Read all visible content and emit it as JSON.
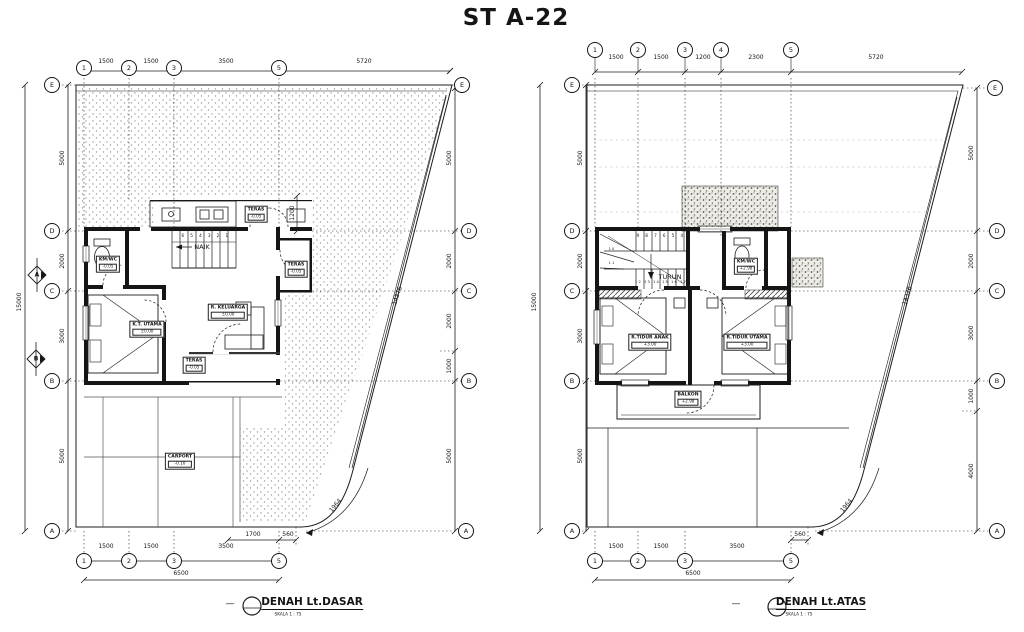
{
  "title": "ST A-22",
  "shared": {
    "diagonal_dim": "14376",
    "corner_arc_dim": "1964",
    "total_height": "15000",
    "total_width": "6500",
    "dash": "—"
  },
  "left_plan": {
    "caption": "DENAH Lt.DASAR",
    "scale": "SKALA 1 : 75",
    "cols": [
      "1",
      "2",
      "3",
      "5"
    ],
    "rows": [
      "E",
      "D",
      "C",
      "B",
      "A"
    ],
    "top_dims": [
      "1500",
      "1500",
      "3500",
      "5720"
    ],
    "bottom_dims": [
      "1500",
      "1500",
      "3500"
    ],
    "sub_dims": {
      "d1700": "1700",
      "d560": "560"
    },
    "left_dims": [
      "5000",
      "2000",
      "3000",
      "5000"
    ],
    "right_dims": [
      "5000",
      "2000",
      "2000",
      "1000",
      "5000"
    ],
    "terrace_depth_dim": "1200",
    "stair_label": "NAIK",
    "stair_numbers": "6 5 4 3 2 1",
    "section_markers": [
      "A",
      "B"
    ],
    "rooms": {
      "kmwc": {
        "name": "KM/WC",
        "elev": "-0.05"
      },
      "teras_top": {
        "name": "TERAS",
        "elev": "-0.05"
      },
      "teras_side": {
        "name": "TERAS",
        "elev": "-0.05"
      },
      "bedroom": {
        "name": "K.T. UTAMA",
        "elev": "±0.00"
      },
      "family": {
        "name": "R. KELUARGA",
        "elev": "±0.00"
      },
      "teras_front": {
        "name": "TERAS",
        "elev": "-0.05"
      },
      "carport": {
        "name": "CARPORT",
        "elev": "-0.10"
      }
    }
  },
  "right_plan": {
    "caption": "DENAH Lt.ATAS",
    "scale": "SKALA 1 : 75",
    "cols": [
      "1",
      "2",
      "3",
      "4",
      "5"
    ],
    "rows": [
      "E",
      "D",
      "C",
      "B",
      "A"
    ],
    "top_dims": [
      "1500",
      "1500",
      "1200",
      "2300",
      "5720"
    ],
    "bottom_dims": [
      "1500",
      "1500",
      "3500"
    ],
    "sub_dims": {
      "d560": "560"
    },
    "left_dims": [
      "5000",
      "2000",
      "3000",
      "5000"
    ],
    "right_dims": [
      "5000",
      "2000",
      "3000",
      "1000",
      "4000"
    ],
    "stair_label": "TURUN",
    "stair_numbers_top": "9 8 7 6 5 4",
    "stair_numbers_bottom": "12 13 14 15 16 17",
    "stair_number_10": "10",
    "stair_number_11": "11",
    "rooms": {
      "kmwc": {
        "name": "KM/WC",
        "elev": "+2.98"
      },
      "bed_anak": {
        "name": "R.TIDUR ANAK",
        "elev": "+3.00"
      },
      "bed_utama": {
        "name": "R.TIDUR UTAMA",
        "elev": "+3.00"
      },
      "balkon": {
        "name": "BALKON",
        "elev": "+2.98"
      }
    }
  }
}
